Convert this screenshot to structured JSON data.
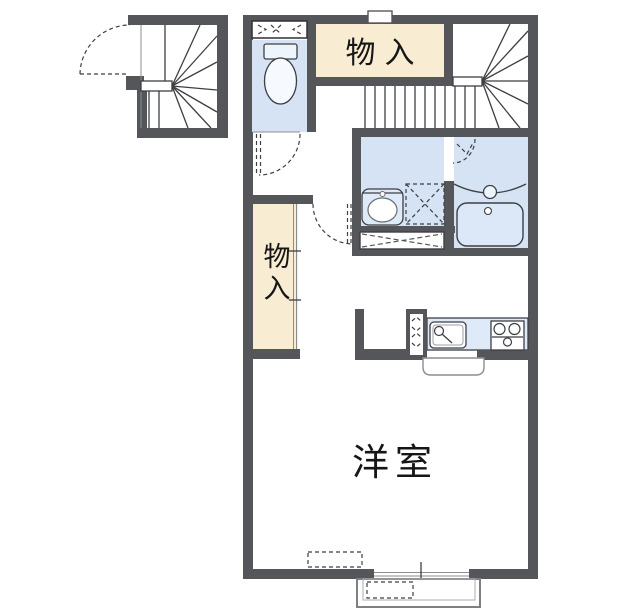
{
  "document": {
    "type": "japanese-apartment-floor-plan"
  },
  "labels": {
    "storage_top": "物入",
    "storage_left": "物入",
    "western_room": "洋室"
  },
  "colors": {
    "background": "#ffffff",
    "wall": "#54565a",
    "room_blue": "#d5e3f5",
    "fixture_blue": "#dfeaf8",
    "storage_cream": "#f8edd3",
    "line": "#3d3f43"
  },
  "icons": [
    "toilet-icon",
    "vent-louver-icon",
    "door-swing-icon",
    "folding-door-icon",
    "washbasin-icon",
    "washing-machine-space-icon",
    "bathtub-icon",
    "bath-faucet-icon",
    "kitchen-sink-icon",
    "stove-icon",
    "pipe-space-icon",
    "staircase-winder-icon",
    "sliding-window-icon",
    "porch-icon"
  ]
}
